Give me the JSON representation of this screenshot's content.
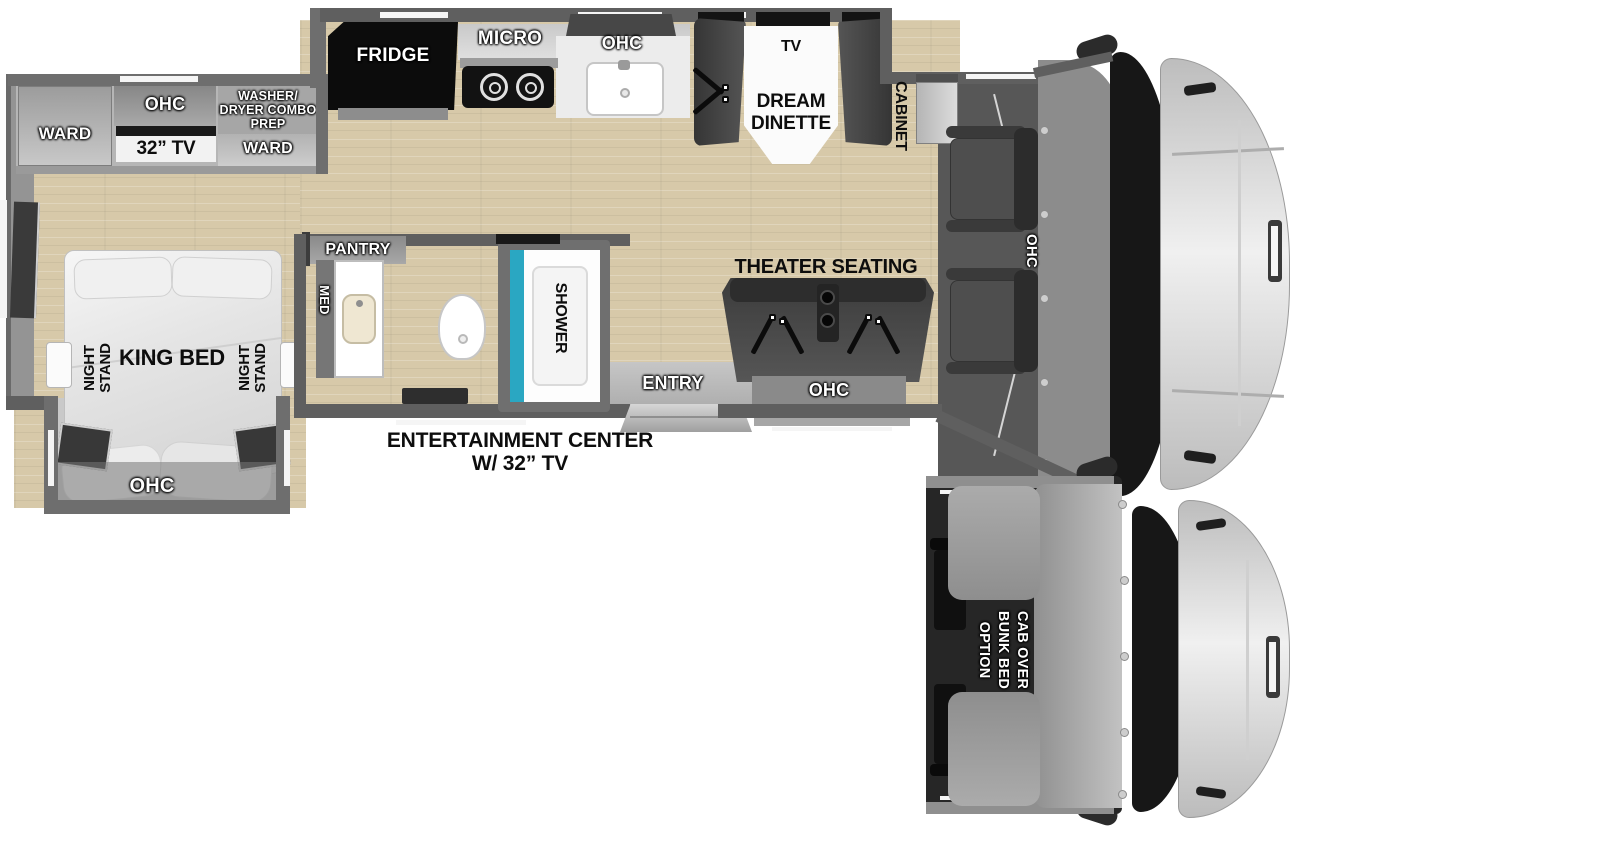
{
  "floorplan": {
    "bedroom": {
      "ward_left": "WARD",
      "ohc": "OHC",
      "tv": "32” TV",
      "washer_prep_lines": [
        "WASHER/",
        "DRYER COMBO",
        "PREP"
      ],
      "ward_right": "WARD",
      "night_stand_lines": [
        "NIGHT",
        "STAND"
      ],
      "king_bed": "KING BED",
      "bed_slide_ohc": "OHC"
    },
    "kitchen": {
      "fridge": "FRIDGE",
      "micro": "MICRO",
      "ohc": "OHC"
    },
    "dinette": {
      "tv": "TV",
      "name_lines": [
        "DREAM",
        "DINETTE"
      ]
    },
    "cabinet": "CABINET",
    "cab": {
      "ohc": "OHC"
    },
    "bathroom": {
      "pantry": "PANTRY",
      "med": "MED",
      "shower": "SHOWER"
    },
    "entry": "ENTRY",
    "theater": {
      "title": "THEATER SEATING",
      "ohc": "OHC"
    },
    "entertainment_lines": [
      "ENTERTAINMENT CENTER",
      "W/ 32” TV"
    ]
  },
  "option": {
    "label_lines": [
      "CAB OVER",
      "BUNK BED",
      "OPTION"
    ]
  },
  "colors": {
    "floor_wood": "#d7c9a9",
    "wall_gray": "#5f5f5f",
    "shower_teal": "#2aa7c2",
    "furniture_dark": "#3f3f3f",
    "cab_hood": "#d8d8d8"
  }
}
